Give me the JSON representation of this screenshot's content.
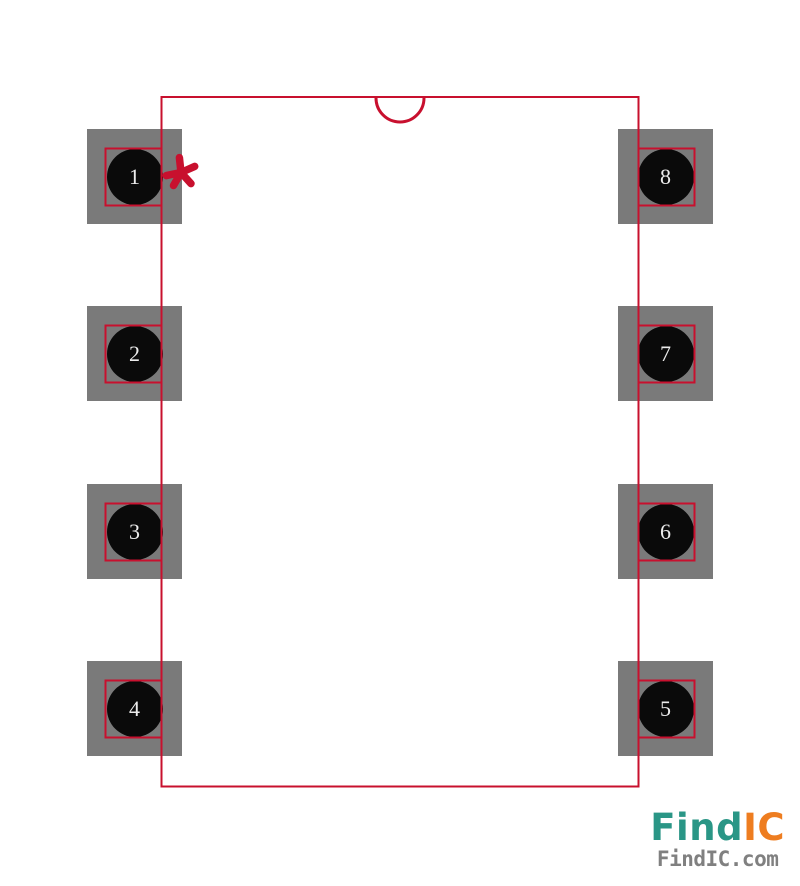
{
  "page": {
    "background_color": "#ffffff",
    "description": "DIP-8 through-hole package footprint / land pattern preview"
  },
  "footprint": {
    "outline_color": "#c8102e",
    "pad_color": "#7a7a7a",
    "hole_color": "#0a0a0a",
    "pin_number_color": "#ececec",
    "pin1_marker": "*",
    "pins": [
      {
        "number": "1"
      },
      {
        "number": "2"
      },
      {
        "number": "3"
      },
      {
        "number": "4"
      },
      {
        "number": "5"
      },
      {
        "number": "6"
      },
      {
        "number": "7"
      },
      {
        "number": "8"
      }
    ]
  },
  "branding": {
    "logo_primary": "Find",
    "logo_accent": "IC",
    "site_url": "FindIC.com",
    "primary_color": "#2a9686",
    "accent_color": "#ee7d20",
    "url_color": "#808080"
  }
}
